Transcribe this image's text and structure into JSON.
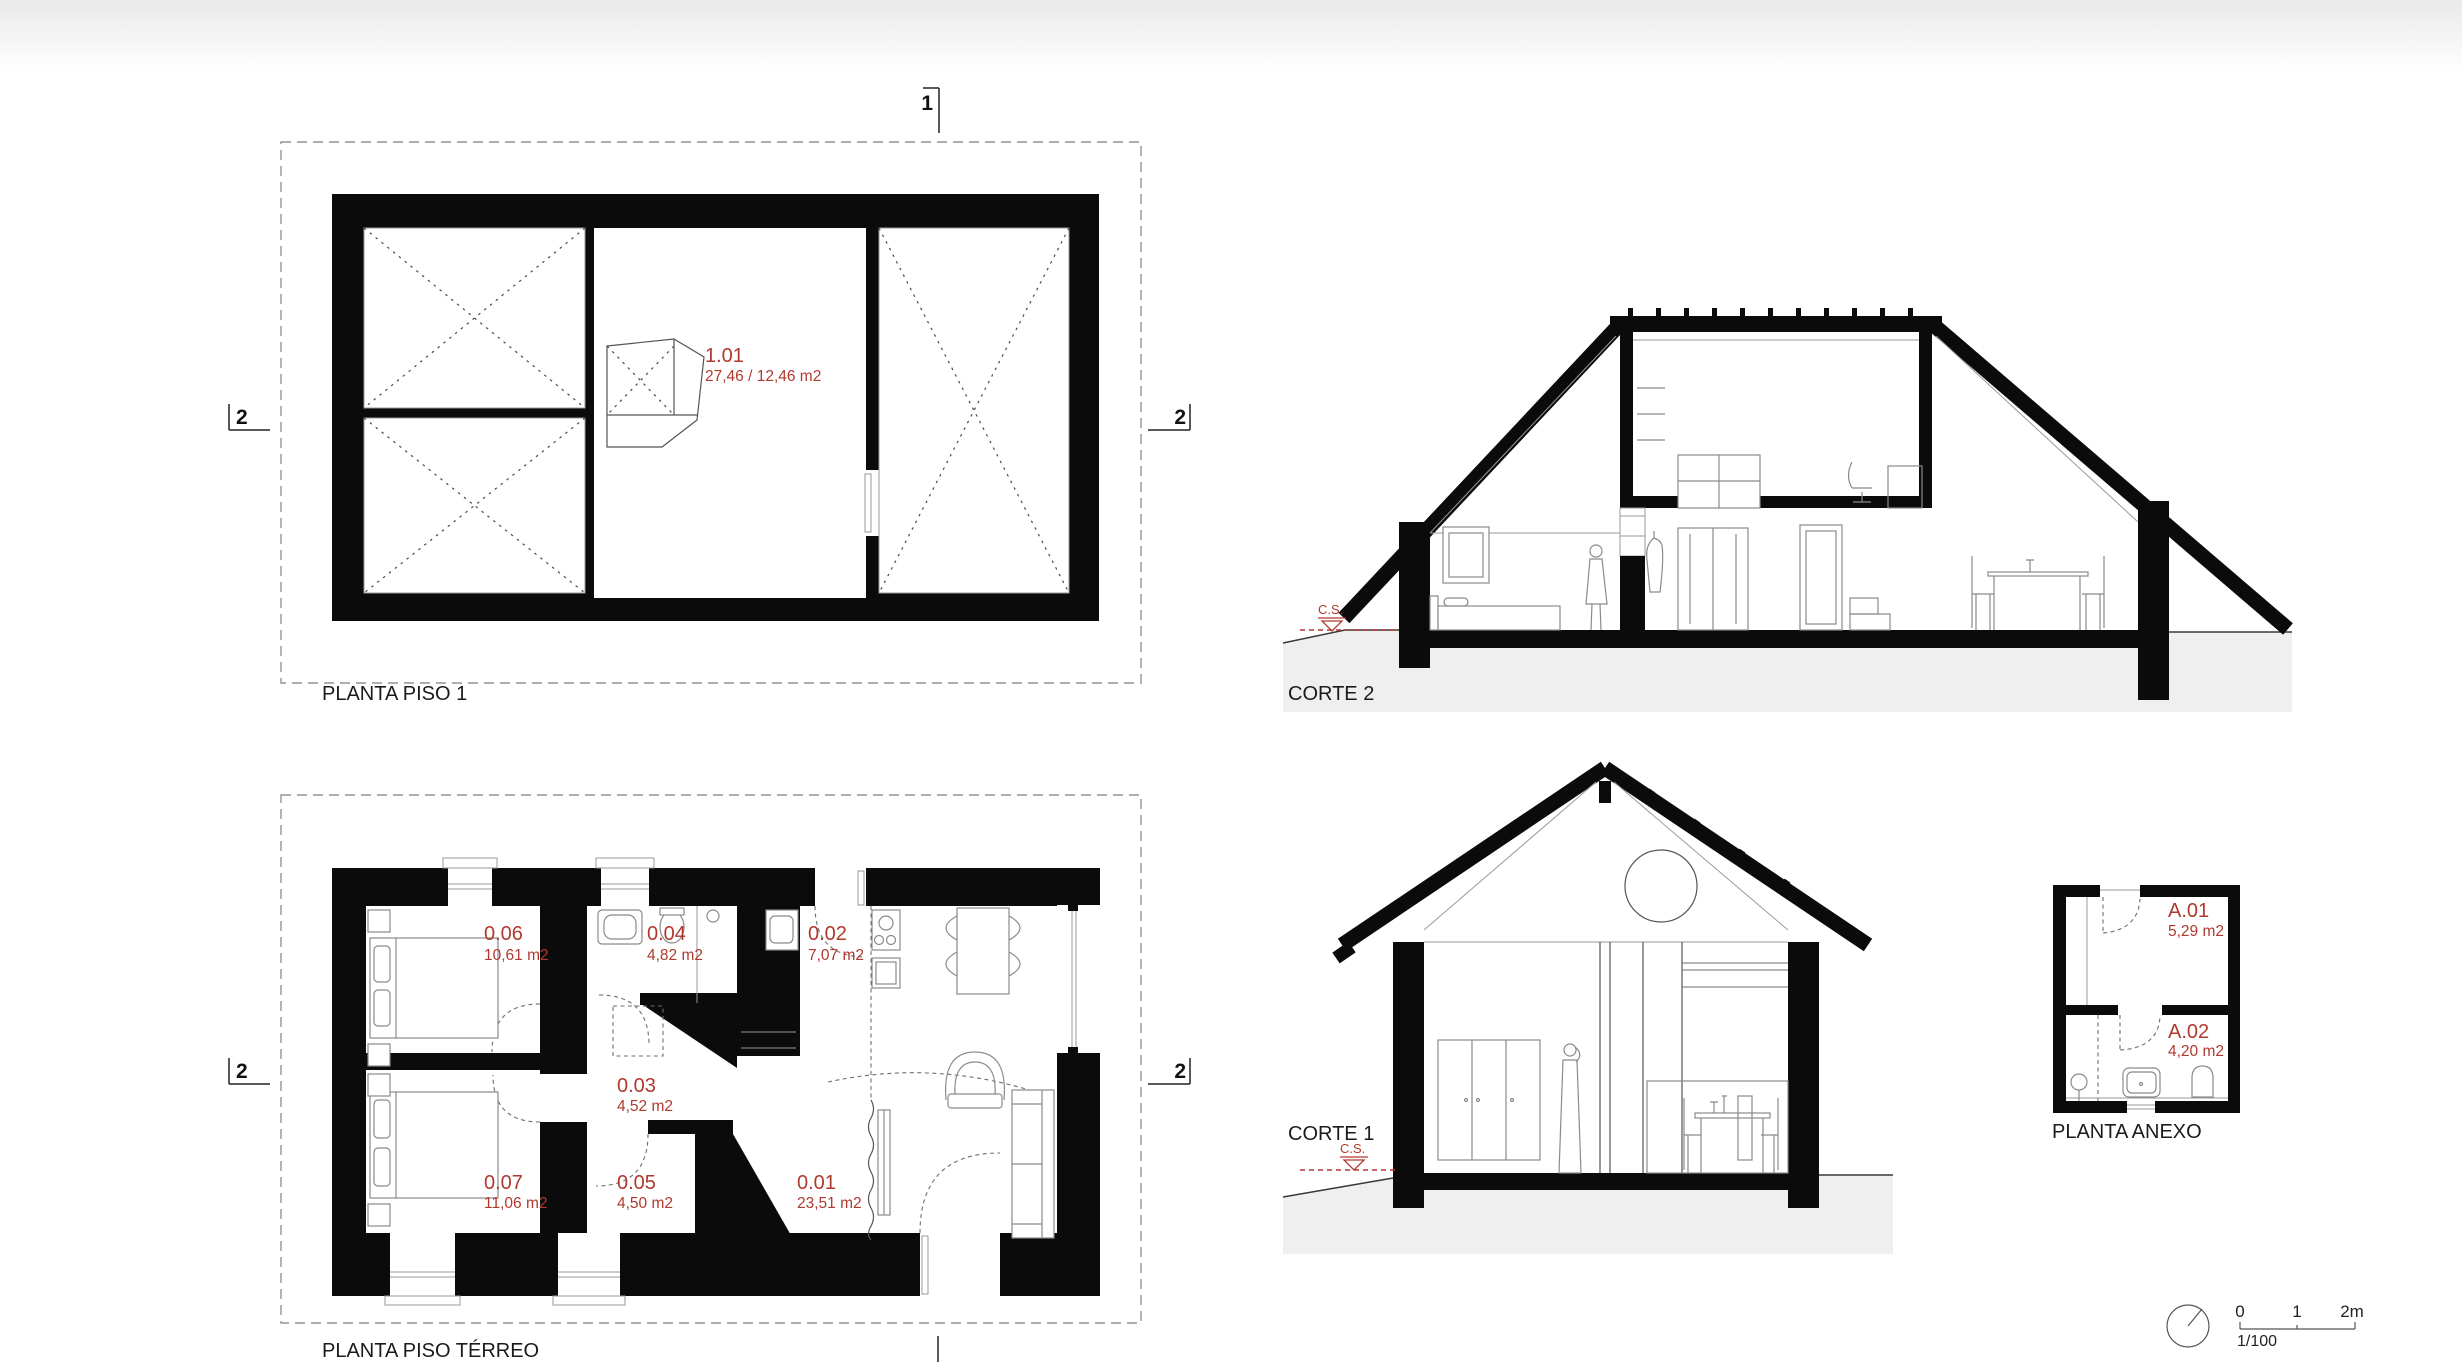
{
  "colors": {
    "accent_red": "#b0392e",
    "wall_black": "#0b0b0b",
    "ground_gray": "#f0eff0"
  },
  "drawings": {
    "piso1": {
      "title": "PLANTA PISO 1",
      "room": {
        "number": "1.01",
        "area": "27,46 / 12,46 m2"
      },
      "markers": {
        "top": "1",
        "left": "2",
        "right": "2"
      }
    },
    "terreo": {
      "title": "PLANTA PISO TÉRREO",
      "markers": {
        "left": "2",
        "right": "2"
      },
      "rooms": [
        {
          "number": "0.06",
          "area": "10,61 m2"
        },
        {
          "number": "0.04",
          "area": "4,82 m2"
        },
        {
          "number": "0.02",
          "area": "7,07 m2"
        },
        {
          "number": "0.03",
          "area": "4,52 m2"
        },
        {
          "number": "0.07",
          "area": "11,06 m2"
        },
        {
          "number": "0.05",
          "area": "4,50 m2"
        },
        {
          "number": "0.01",
          "area": "23,51 m2"
        }
      ]
    },
    "corte2": {
      "title": "CORTE 2",
      "level_marker": "C.S."
    },
    "corte1": {
      "title": "CORTE 1",
      "level_marker": "C.S."
    },
    "anexo": {
      "title": "PLANTA ANEXO",
      "rooms": [
        {
          "number": "A.01",
          "area": "5,29 m2"
        },
        {
          "number": "A.02",
          "area": "4,20 m2"
        }
      ]
    },
    "scale": {
      "tick_0": "0",
      "tick_1": "1",
      "tick_2": "2m",
      "ratio": "1/100"
    }
  }
}
